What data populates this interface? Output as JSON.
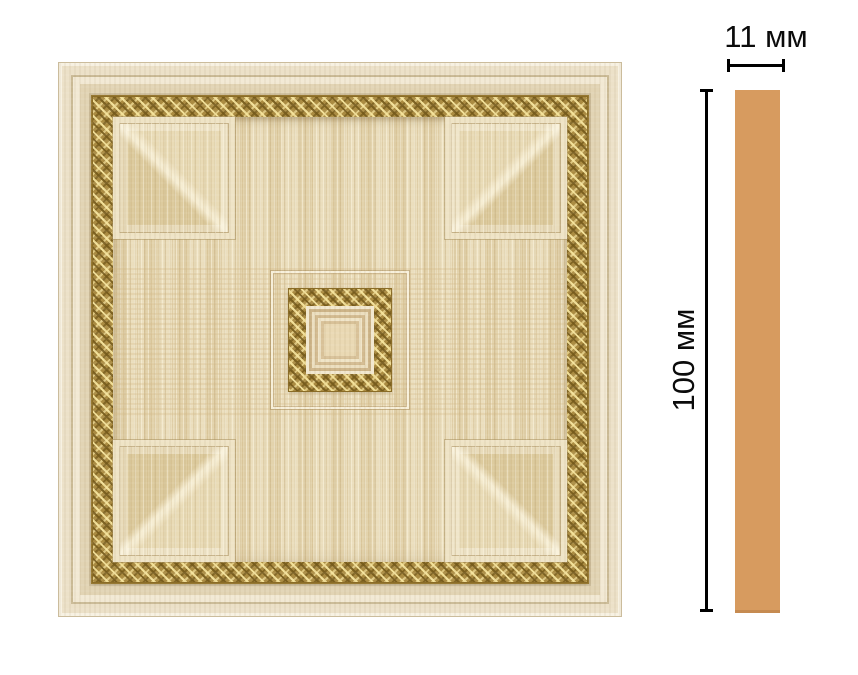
{
  "figure": {
    "description": "decorative molding panel with dimension callouts"
  },
  "dimensions": {
    "width_label": "11 мм",
    "height_label": "100 мм"
  },
  "colors": {
    "background": "#ffffff",
    "dimension_line": "#000000",
    "profile_strip": "#d79b5f",
    "frame_cream": "#efe5cd",
    "gold_ornament": "#ab8c42",
    "wood_field": "#e8dab6"
  }
}
